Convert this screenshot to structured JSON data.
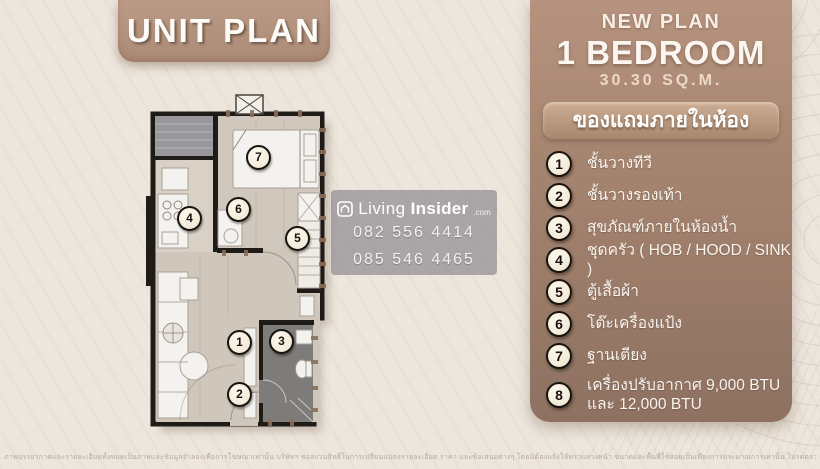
{
  "title_plate": {
    "label": "UNIT PLAN"
  },
  "panel": {
    "new_plan": "NEW PLAN",
    "bedroom": "1 BEDROOM",
    "area": "30.30 SQ.M.",
    "gift_header": "ของแถมภายในห้อง",
    "items": [
      {
        "num": "1",
        "label": "ชั้นวางทีวี"
      },
      {
        "num": "2",
        "label": "ชั้นวางรองเท้า"
      },
      {
        "num": "3",
        "label": "สุขภัณฑ์ภายในห้องน้ำ"
      },
      {
        "num": "4",
        "label": "ชุดครัว ( HOB / HOOD / SINK )"
      },
      {
        "num": "5",
        "label": "ตู้เสื้อผ้า"
      },
      {
        "num": "6",
        "label": "โต๊ะเครื่องแป้ง"
      },
      {
        "num": "7",
        "label": "ฐานเตียง"
      },
      {
        "num": "8",
        "label": "เครื่องปรับอากาศ 9,000 BTU",
        "label2": "และ 12,000 BTU"
      }
    ]
  },
  "watermark": {
    "brand_living": "Living",
    "brand_insider": "Insider",
    "brand_tld": ".com",
    "phone1": "082 556 4414",
    "phone2": "085 546 4465"
  },
  "floorplan": {
    "badges": [
      {
        "num": "1"
      },
      {
        "num": "2"
      },
      {
        "num": "3"
      },
      {
        "num": "4"
      },
      {
        "num": "5"
      },
      {
        "num": "6"
      },
      {
        "num": "7"
      }
    ]
  },
  "disclaimer": "ภาพบรรยากาศและรายละเอียดทั้งหมดเป็นภาพและข้อมูลจำลองเพื่อการโฆษณาเท่านั้น บริษัทฯ ขอสงวนสิทธิ์ในการเปลี่ยนแปลงรายละเอียด ราคา และข้อเสนอต่างๆ โดยมิต้องแจ้งให้ทราบล่วงหน้า ขนาดและพื้นที่ใช้สอยเป็นเพียงการประมาณการเท่านั้น โปรดตรวจสอบรายละเอียดเพิ่มเติม ณ สำนักงานขายโครงการ",
  "colors": {
    "background": "#ede6dd",
    "panel_top": "#b6937e",
    "panel_bottom": "#8e7161",
    "plate": "#b2917e",
    "header_bar": "#cdad93",
    "badge_fill": "#f6f0e4",
    "badge_border": "#17130f",
    "bathroom": "#7e7c7a",
    "balcony": "#98979b",
    "walls": "#1f1b17",
    "text_light": "#f8f4ef"
  }
}
